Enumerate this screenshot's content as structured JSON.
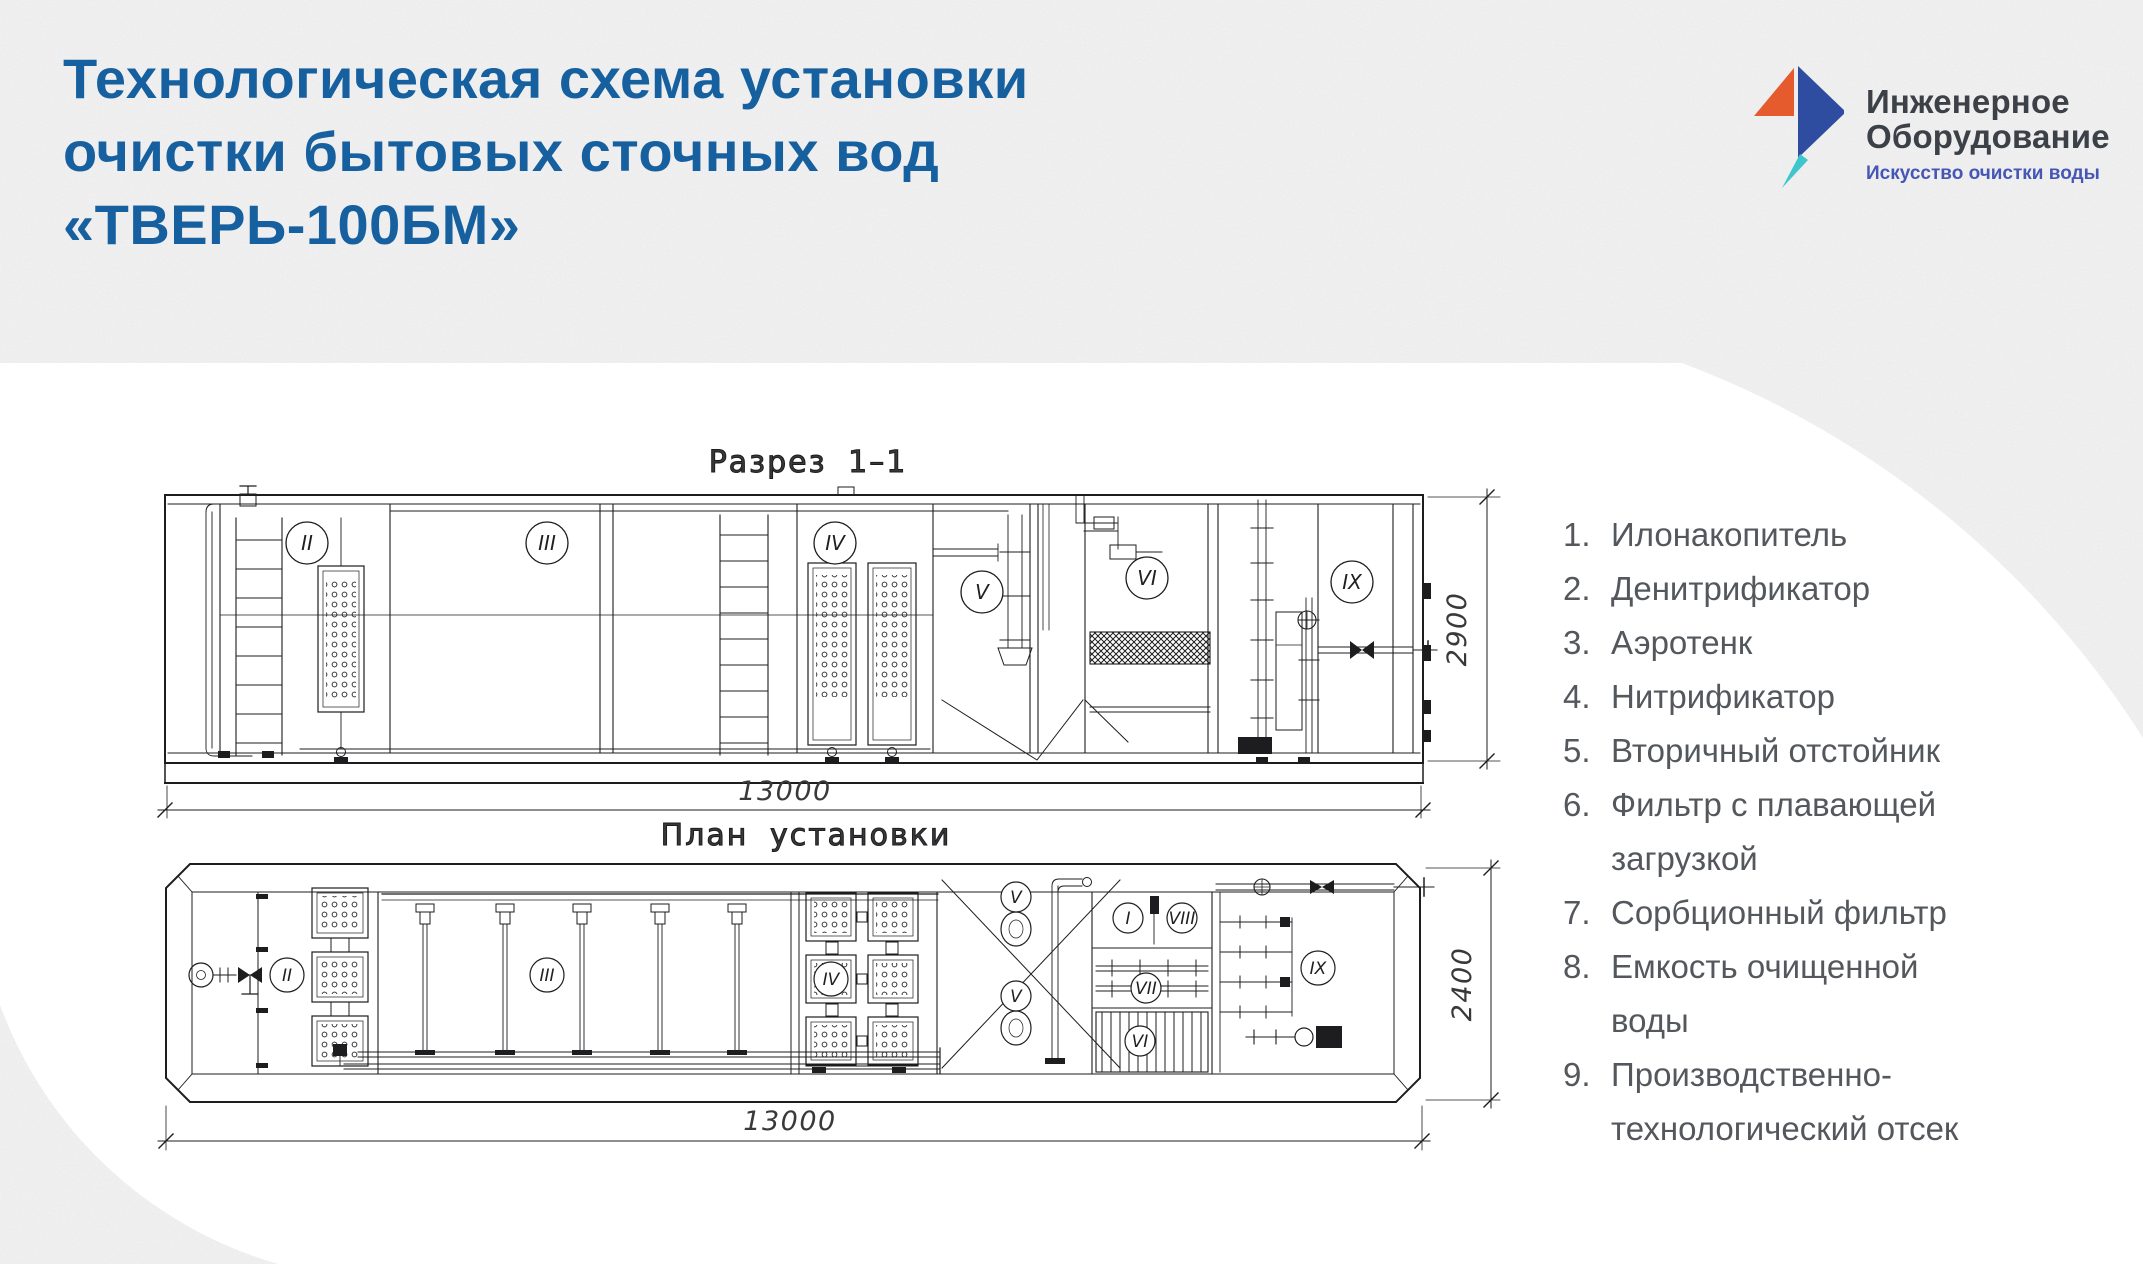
{
  "page": {
    "background_color": "#D9DADB",
    "surface_color": "#FFFFFF"
  },
  "header": {
    "title_line1": "Технологическая схема установки",
    "title_line2": "очистки бытовых сточных вод",
    "title_line3": "«ТВЕРЬ-100БМ»",
    "title_color": "#16609F"
  },
  "logo": {
    "name_line1": "Инженерное",
    "name_line2": "Оборудование",
    "tagline": "Искусство очистки воды",
    "colors": {
      "orange": "#E55B2D",
      "blue": "#2F4DA0",
      "teal": "#3EC6CE",
      "name_text": "#3B4147",
      "tagline_text": "#4656B4"
    }
  },
  "legend": {
    "text_color": "#54585D",
    "items": [
      {
        "num": "1.",
        "label": "Илонакопитель"
      },
      {
        "num": "2.",
        "label": "Денитрификатор"
      },
      {
        "num": "3.",
        "label": "Аэротенк"
      },
      {
        "num": "4.",
        "label": "Нитрификатор"
      },
      {
        "num": "5.",
        "label": "Вторичный отстойник"
      },
      {
        "num": "6.",
        "label": "Фильтр с плавающей загрузкой"
      },
      {
        "num": "7.",
        "label": "Сорбционный фильтр"
      },
      {
        "num": "8.",
        "label": "Емкость очищенной воды"
      },
      {
        "num": "9.",
        "label": "Производственно-технологический отсек"
      }
    ]
  },
  "drawings": {
    "line_color": "#1D1D1F",
    "section": {
      "label": "Разрез 1–1",
      "length_dim": "13000",
      "height_dim": "2900",
      "compartments": [
        "II",
        "III",
        "IV",
        "V",
        "VI",
        "IX"
      ]
    },
    "plan": {
      "label": "План установки",
      "length_dim": "13000",
      "width_dim": "2400",
      "compartments": [
        "II",
        "III",
        "IV",
        "V",
        "V",
        "I",
        "VIII",
        "VII",
        "VI",
        "IX"
      ]
    }
  }
}
